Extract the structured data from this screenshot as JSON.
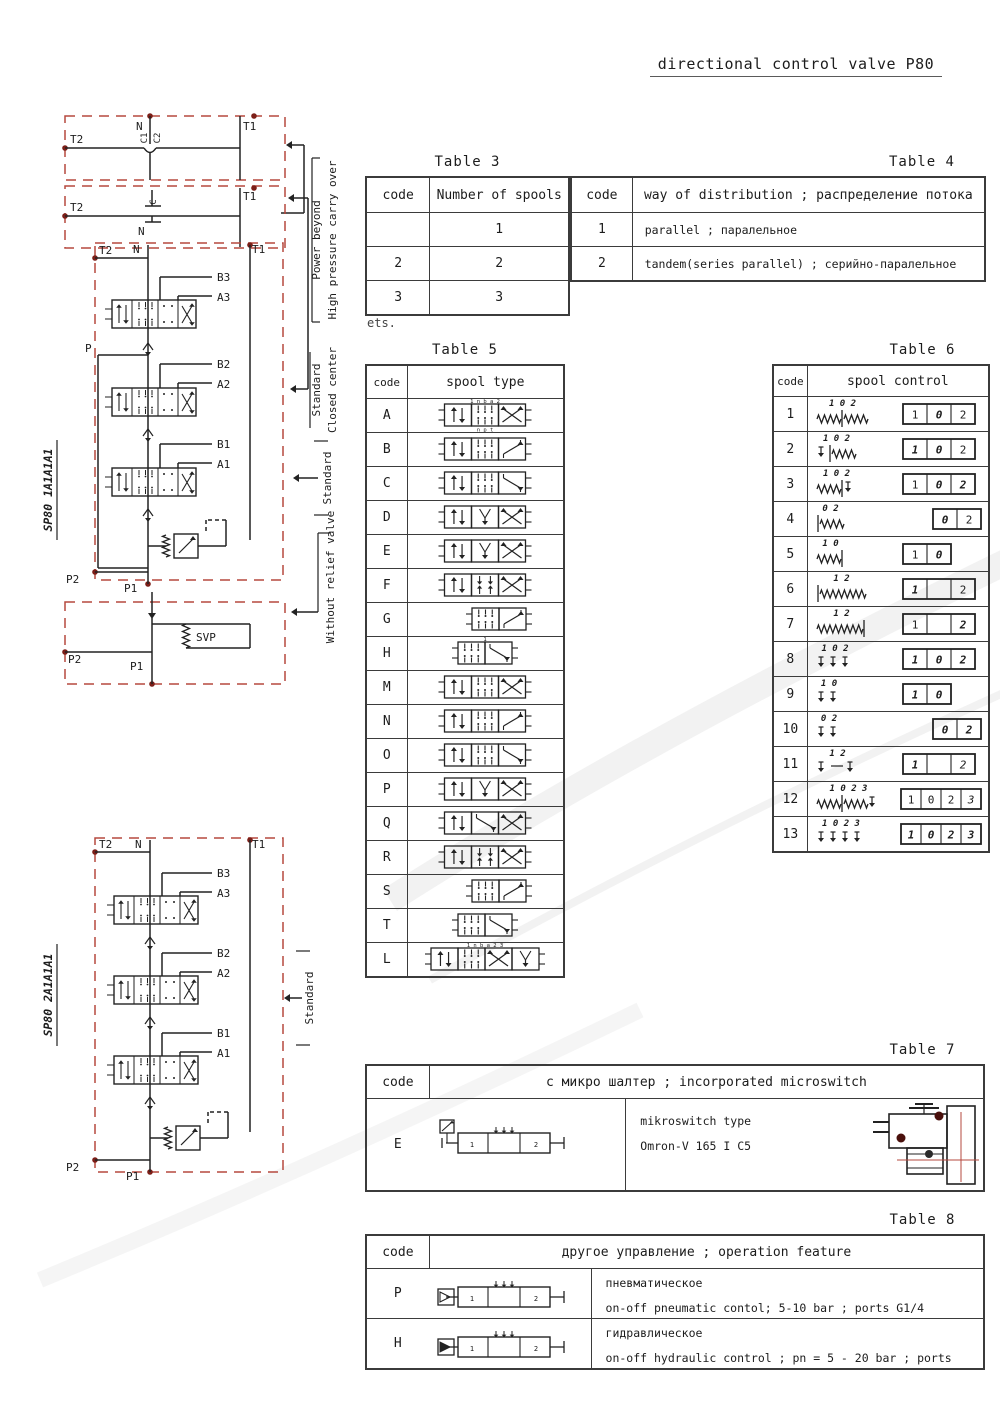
{
  "title": "directional control valve P80",
  "note_under_table3": "ets.",
  "colors": {
    "dashed_red": "#b5493f",
    "port_dot": "#7c1f18",
    "line": "#222222",
    "watermark": "#dedede"
  },
  "circuits": {
    "power_beyond": {
      "t2": "T2",
      "n": "N",
      "c1": "C1",
      "c2": "C2",
      "t1": "T1"
    },
    "closed_center": {
      "t2": "T2",
      "c": "C",
      "n": "N",
      "t1": "T1"
    },
    "main1": {
      "model": "SP80 1A1A1A1",
      "t2": "T2",
      "t1": "T1",
      "n": "N",
      "p": "P",
      "b3": "B3",
      "a3": "A3",
      "b2": "B2",
      "a2": "A2",
      "b1": "B1",
      "a1": "A1",
      "p2": "P2",
      "p1": "P1"
    },
    "no_relief": {
      "svp": "SVP",
      "p2": "P2",
      "p1": "P1"
    },
    "main2": {
      "model": "SP80 2A1A1A1",
      "t2": "T2",
      "t1": "T1",
      "n": "N",
      "b3": "B3",
      "a3": "A3",
      "b2": "B2",
      "a2": "A2",
      "b1": "B1",
      "a1": "A1",
      "p2": "P2",
      "p1": "P1"
    },
    "side_labels": {
      "pb1": "Power beyond",
      "pb2": "High pressure carry over",
      "scc1": "Standard",
      "scc2": "Closed center",
      "std": "Standard",
      "wrv": "Without relief valve",
      "std2": "Standard"
    }
  },
  "tables": {
    "t3": {
      "title": "Table 3",
      "headers": [
        "code",
        "Number of spools"
      ],
      "rows": [
        [
          "",
          "1"
        ],
        [
          "2",
          "2"
        ],
        [
          "3",
          "3"
        ]
      ]
    },
    "t4": {
      "title": "Table 4",
      "headers": [
        "code",
        "way of distribution ; распределение потока"
      ],
      "rows": [
        [
          "1",
          "parallel ; паралельное"
        ],
        [
          "2",
          "tandem(series parallel) ; серийно-паралельное"
        ]
      ]
    },
    "t5": {
      "title": "Table 5",
      "headers": [
        "code",
        "spool type"
      ],
      "rows": [
        {
          "code": "A",
          "sym": "u,c,x",
          "top": "1   n b a   2",
          "bottom": "n p t"
        },
        {
          "code": "B",
          "sym": "u,c,z"
        },
        {
          "code": "C",
          "sym": "u,c,n"
        },
        {
          "code": "D",
          "sym": "u,y,x"
        },
        {
          "code": "E",
          "sym": "u,y,x"
        },
        {
          "code": "F",
          "sym": "u,t,x"
        },
        {
          "code": "G",
          "sym": "c,z",
          "shift": 1
        },
        {
          "code": "H",
          "sym": "c,n",
          "top": "1"
        },
        {
          "code": "M",
          "sym": "u,c,x"
        },
        {
          "code": "N",
          "sym": "u,c,z"
        },
        {
          "code": "O",
          "sym": "u,c,n"
        },
        {
          "code": "P",
          "sym": "u,y,x"
        },
        {
          "code": "Q",
          "sym": "u,n,x"
        },
        {
          "code": "R",
          "sym": "u,t,x"
        },
        {
          "code": "S",
          "sym": "c,z",
          "shift": 1
        },
        {
          "code": "T",
          "sym": "c,n"
        },
        {
          "code": "L",
          "sym": "u,c,x,y",
          "top": "1  n b a  2    3"
        }
      ]
    },
    "t6": {
      "title": "Table 6",
      "headers": [
        "code",
        "spool control"
      ],
      "rows": [
        {
          "code": "1",
          "mech": "w|w",
          "lbl": "1 0 2",
          "boxes": [
            [
              "1",
              0
            ],
            [
              "0",
              1
            ],
            [
              "2",
              0
            ]
          ]
        },
        {
          "code": "2",
          "mech": "v|w",
          "lbl": "1 0 2",
          "boxes": [
            [
              "1",
              1
            ],
            [
              "0",
              1
            ],
            [
              "2",
              0
            ]
          ]
        },
        {
          "code": "3",
          "mech": "w|v",
          "lbl": "1 0 2",
          "boxes": [
            [
              "1",
              0
            ],
            [
              "0",
              1
            ],
            [
              "2",
              1
            ]
          ]
        },
        {
          "code": "4",
          "mech": "|w",
          "lbl": "0 2",
          "boxes": [
            [
              "0",
              1
            ],
            [
              "2",
              0
            ]
          ],
          "align": "right"
        },
        {
          "code": "5",
          "mech": "w|",
          "lbl": "1 0",
          "boxes": [
            [
              "1",
              0
            ],
            [
              "0",
              1
            ]
          ]
        },
        {
          "code": "6",
          "mech": "|W",
          "lbl": "1   2",
          "boxes": [
            [
              "1",
              1
            ],
            [
              "",
              0
            ],
            [
              "2",
              0
            ]
          ]
        },
        {
          "code": "7",
          "mech": "W|",
          "lbl": "1   2",
          "boxes": [
            [
              "1",
              0
            ],
            [
              "",
              0
            ],
            [
              "2",
              1
            ]
          ]
        },
        {
          "code": "8",
          "mech": "vvv",
          "lbl": "1 0 2",
          "boxes": [
            [
              "1",
              1
            ],
            [
              "0",
              1
            ],
            [
              "2",
              1
            ]
          ]
        },
        {
          "code": "9",
          "mech": "vv",
          "lbl": "1 0",
          "boxes": [
            [
              "1",
              1
            ],
            [
              "0",
              1
            ]
          ]
        },
        {
          "code": "10",
          "mech": "vv",
          "lbl": "0 2",
          "boxes": [
            [
              "0",
              1
            ],
            [
              "2",
              1
            ]
          ],
          "align": "right"
        },
        {
          "code": "11",
          "mech": "v-v",
          "lbl": "1   2",
          "boxes": [
            [
              "1",
              1
            ],
            [
              "",
              0
            ],
            [
              "2",
              2
            ]
          ]
        },
        {
          "code": "12",
          "mech": "w|wv",
          "lbl": "1 0 2 3",
          "boxes": [
            [
              "1",
              0
            ],
            [
              "0",
              0
            ],
            [
              "2",
              0
            ],
            [
              "3",
              2
            ]
          ]
        },
        {
          "code": "13",
          "mech": "vvvv",
          "lbl": "1 0 2 3",
          "boxes": [
            [
              "1",
              1
            ],
            [
              "0",
              1
            ],
            [
              "2",
              1
            ],
            [
              "3",
              1
            ]
          ]
        }
      ]
    },
    "t7": {
      "title": "Table 7",
      "headers": [
        "code",
        "с микро шалтер ; incorporated microswitch"
      ],
      "rows": [
        {
          "code": "E",
          "text1": "mikroswitch type",
          "text2": "Omron-V 165 I C5"
        }
      ]
    },
    "t8": {
      "title": "Table 8",
      "headers": [
        "code",
        "другое управление ; operation feature"
      ],
      "rows": [
        {
          "code": "P",
          "line1": "пневматическое",
          "line2": "on-off pneumatic contol; 5-10 bar ; ports G1/4"
        },
        {
          "code": "H",
          "line1": "гидравлическое",
          "line2": "on-off hydraulic control ; pn = 5 - 20 bar ; ports G1/4"
        }
      ]
    }
  }
}
